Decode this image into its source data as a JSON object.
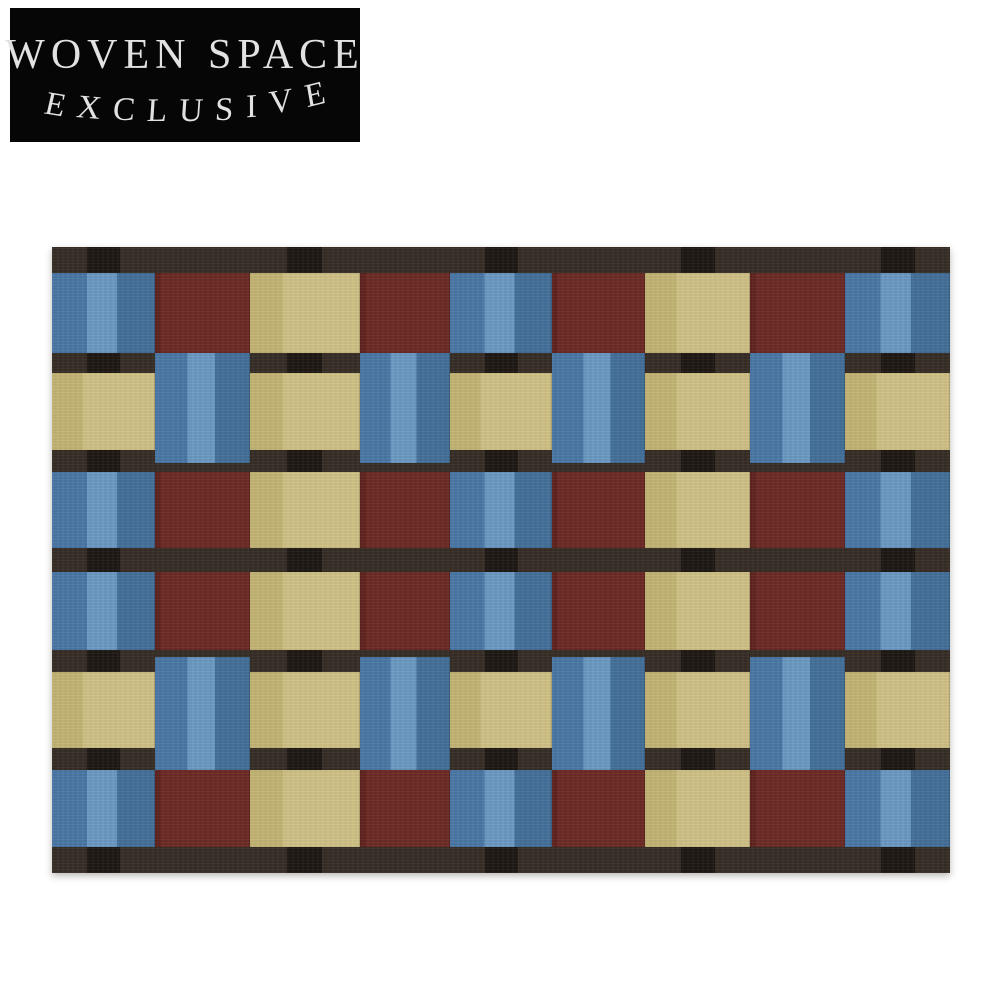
{
  "page": {
    "background": "#ffffff"
  },
  "badge": {
    "line1": "WOVEN SPACE",
    "line2": "EXCLUSIVE",
    "background": "#060606",
    "text_color": "#e2e2e2"
  },
  "rug": {
    "description": "checkered woven rug in blue, maroon and tan squares with dark brown weft bands",
    "x": 52,
    "y": 247,
    "width": 898,
    "height": 626,
    "colors": {
      "blue_mid": "#4a78a6",
      "blue_light": "#6b9ac4",
      "blue_dark": "#44709b",
      "maroon": "#6d2a25",
      "maroon_edge": "#5f231f",
      "tan": "#d0c286",
      "tan_shade": "#c3b574",
      "band_brown": "#362d26",
      "band_black": "#1e1813"
    },
    "columns": {
      "x": [
        0,
        103,
        198,
        308,
        398,
        500,
        593,
        698,
        793
      ],
      "w": [
        103,
        95,
        110,
        90,
        102,
        93,
        105,
        95,
        105
      ]
    },
    "bands": [
      {
        "y": 0,
        "h": 26
      },
      {
        "y": 106,
        "h": 20
      },
      {
        "y": 203,
        "h": 22
      },
      {
        "y": 301,
        "h": 24
      },
      {
        "y": 403,
        "h": 22
      },
      {
        "y": 501,
        "h": 22
      },
      {
        "y": 600,
        "h": 26
      }
    ],
    "rows": [
      {
        "y": 26,
        "h": 80
      },
      {
        "y": 126,
        "h": 77
      },
      {
        "y": 225,
        "h": 76
      },
      {
        "y": 325,
        "h": 78
      },
      {
        "y": 425,
        "h": 76
      },
      {
        "y": 523,
        "h": 77
      }
    ],
    "row_types": [
      "A",
      "B",
      "A",
      "A",
      "B",
      "A"
    ],
    "patterns": {
      "A": [
        "blue",
        "maroon",
        "tan",
        "maroon",
        "blue",
        "maroon",
        "tan",
        "maroon",
        "blue"
      ],
      "B": [
        "tan",
        "blue",
        "tan",
        "blue",
        "tan",
        "blue",
        "tan",
        "blue",
        "tan"
      ]
    },
    "warp_columns": [
      0,
      2,
      4,
      6,
      8
    ],
    "warp_frac": {
      "left": 0.34,
      "width": 0.32
    },
    "blue_overlaps": {
      "1": {
        "y": 106,
        "h": 110
      },
      "4": {
        "y": 410,
        "h": 113
      }
    }
  }
}
